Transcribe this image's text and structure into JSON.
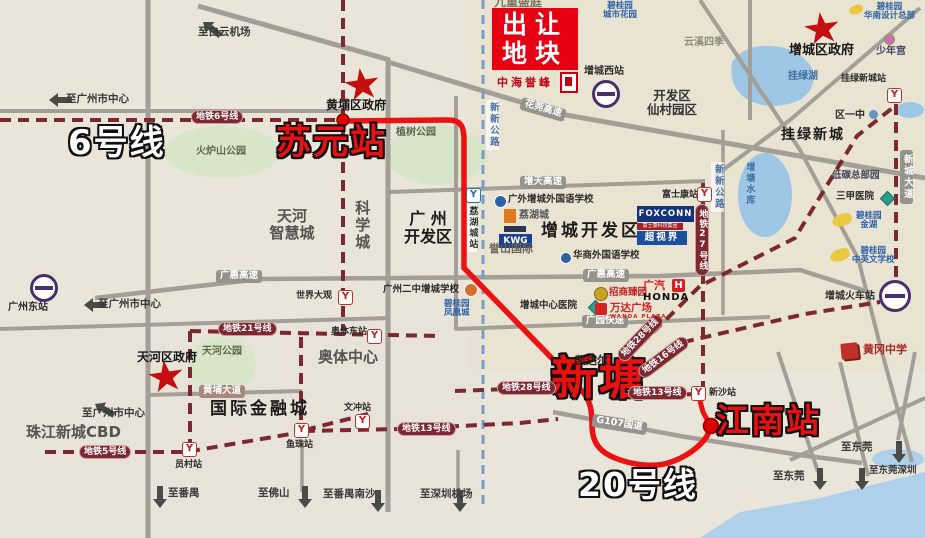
{
  "parcel": {
    "line1": "出让",
    "line2": "地块",
    "developer": "中海誉峰"
  },
  "highlights": {
    "line6": "6号线",
    "line20": "20号线",
    "suyuan": "苏元站",
    "xintang": "新塘",
    "jiangnan": "江南站"
  },
  "government": {
    "huangpu": "黄埔区政府",
    "tianhe": "天河区政府",
    "zengcheng": "增城区政府"
  },
  "stations": {
    "guangzhou_east": "广州东站",
    "shijiedaguan": "世界大观",
    "aoti_east": "奥体东站",
    "wenchong": "文冲站",
    "yuancun": "员村站",
    "yuzhu": "鱼珠站",
    "xinsha": "新沙站",
    "foxconn": "富士康站",
    "lihucheng": "荔湖城站",
    "zengcheng_west": "增城西站",
    "zengcheng_railway": "增城火车站",
    "gualv_new_town": "挂绿新城站"
  },
  "metro_lines": {
    "l5": "地铁5号线",
    "l6": "地铁6号线",
    "l13": "地铁13号线",
    "l16": "地铁16号线",
    "l21": "地铁21号线",
    "l27": "地铁27号线",
    "l28": "地铁28号线"
  },
  "roads": {
    "huaguan": "花莞高速",
    "zengtian": "增天高速",
    "guanghui": "广惠高速",
    "guangyuan": "广园快速",
    "huangpu_ave": "黄埔大道",
    "g107": "G107国道",
    "xinxin": "新新公路",
    "xincheng_ave": "新城大道"
  },
  "directions": {
    "baiyun_airport": "至白云机场",
    "gz_center": "至广州市中心",
    "panyu": "至番禺",
    "foshan": "至佛山",
    "panyu_nansha": "至番禺南沙",
    "shenzhen_airport": "至深圳机场",
    "dongguan": "至东莞",
    "dongguan_shenzhen": "至东莞深圳"
  },
  "areas": {
    "tianhe_smart_l1": "天河",
    "tianhe_smart_l2": "智慧城",
    "science_city": "科学城",
    "gz_dev_l1": "广 州",
    "gz_dev_l2": "开发区",
    "zc_dev": "增城开发区",
    "aoti_center": "奥体中心",
    "intl_finance": "国际金融城",
    "zhujiang_cbd": "珠江新城CBD",
    "kaifaqu_l1": "开发区",
    "kaifaqu_l2": "仙村园区",
    "gualv_town": "挂绿新城",
    "kaidaer": "凯达尔"
  },
  "nature": {
    "huolushan": "火炉山公园",
    "zhishu": "植树公园",
    "tianhe_park": "天河公园",
    "gualv_lake": "挂绿湖",
    "zengtang_reservoir": "增塘水库"
  },
  "pois": {
    "gwaifl_school": "广外增城外国语学校",
    "huashang_school": "华商外国语学校",
    "gz_no2_school": "广州二中增城学校",
    "zc_hospital": "增城中心医院",
    "sanjia_hospital": "三甲医院",
    "low_carbon_park": "低碳总部园",
    "bgy_jinhu_l1": "碧桂园",
    "bgy_jinhu_l2": "金湖",
    "bgy_school_l1": "碧桂园",
    "bgy_school_l2": "中英文学校",
    "bgy_city_l1": "碧桂园",
    "bgy_city_l2": "城市花园",
    "bgy_design_l1": "碧桂园",
    "bgy_design_l2": "华南设计总部",
    "youth_palace": "少年宫",
    "district_no1": "区一中",
    "yunxi": "云溪四季",
    "jiuzhong": "九重盛庭",
    "lihucheng_estate": "荔湖城",
    "yushan_intl": "誉山国际",
    "kwg": "KWG",
    "foxconn_en": "FOXCONN",
    "foxconn_cn": "富士康科技集团",
    "chaoshijie": "超视界",
    "zhaoshang": "招商臻园",
    "wanda": "万达广场",
    "wanda_en": "WANDA PLAZA",
    "gac": "广汽",
    "honda": "HONDA",
    "honda_h": "H",
    "huanggang": "黄冈中学",
    "phoenix_l1": "碧桂园",
    "phoenix_l2": "凤凰城"
  }
}
